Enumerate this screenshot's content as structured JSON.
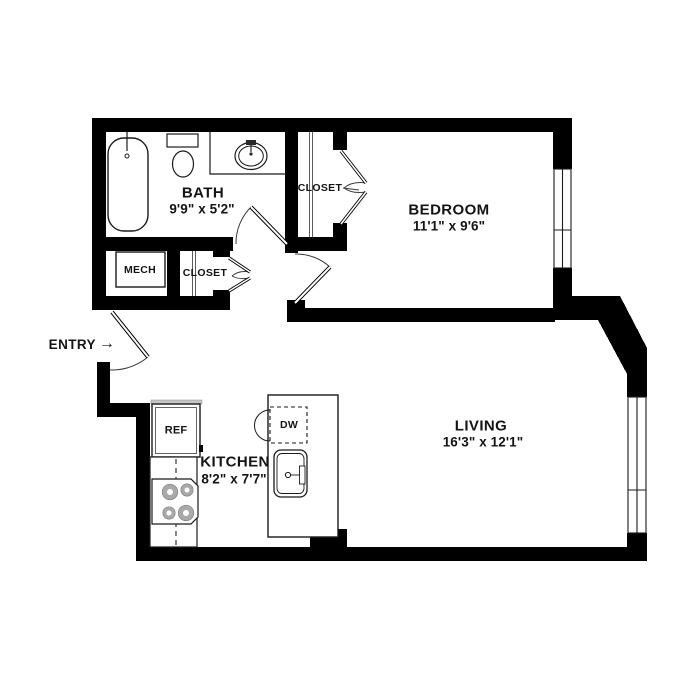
{
  "rooms": {
    "bath": {
      "name": "BATH",
      "dims": "9'9\" x 5'2\""
    },
    "bedroom": {
      "name": "BEDROOM",
      "dims": "11'1\" x 9'6\""
    },
    "living": {
      "name": "LIVING",
      "dims": "16'3\" x 12'1\""
    },
    "kitchen": {
      "name": "KITCHEN",
      "dims": "8'2\" x 7'7\""
    },
    "mech": {
      "name": "MECH"
    },
    "hallCloset": {
      "name": "CLOSET"
    },
    "bedroomCloset": {
      "name": "CLOSET"
    }
  },
  "appliances": {
    "refrigerator": "REF",
    "dishwasher": "DW"
  },
  "entry": {
    "label": "ENTRY",
    "arrow": "→"
  },
  "colors": {
    "wall": "#000000",
    "line": "#2b2b2b",
    "burner": "#a9a9a9",
    "background": "#ffffff"
  }
}
